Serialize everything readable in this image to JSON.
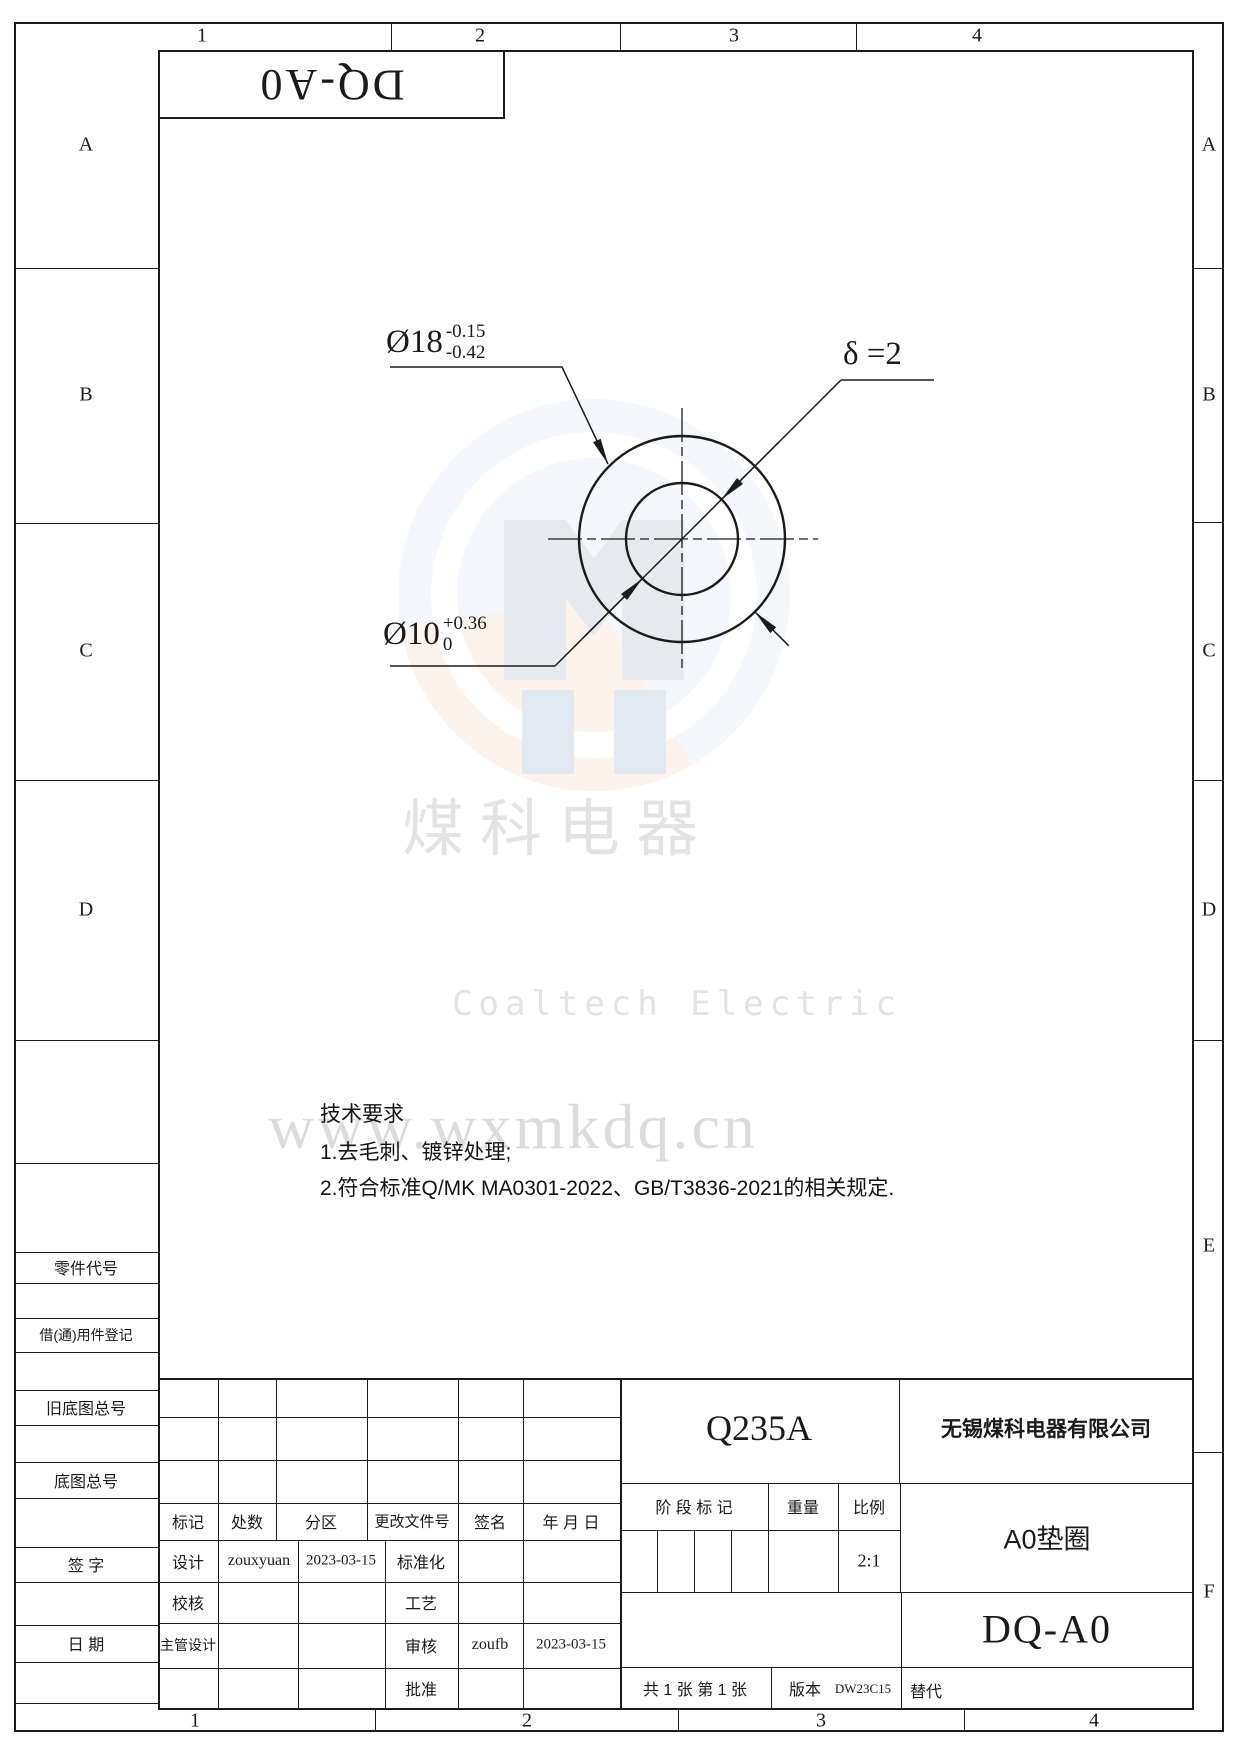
{
  "zones": {
    "top": [
      "1",
      "2",
      "3",
      "4"
    ],
    "bottom": [
      "1",
      "2",
      "3",
      "4"
    ],
    "left": [
      "A",
      "B",
      "C",
      "D"
    ],
    "right": [
      "A",
      "B",
      "C",
      "D",
      "E",
      "F"
    ]
  },
  "margin_labels": {
    "part_code": "零件代号",
    "borrow": "借(通)用件登记",
    "old_master": "旧底图总号",
    "master": "底图总号",
    "sign": "签 字",
    "date": "日 期"
  },
  "stamp": {
    "text": "DQ-A0"
  },
  "drawing": {
    "outer_dia": {
      "base": "Ø18",
      "upper": "-0.15",
      "lower": "-0.42"
    },
    "inner_dia": {
      "base": "Ø10",
      "upper": "+0.36",
      "lower": "0"
    },
    "thickness": "δ =2"
  },
  "watermark": {
    "cn": "煤科电器",
    "en": "Coaltech Electric",
    "url": "www.wxmkdq.cn"
  },
  "tech": {
    "title": "技术要求",
    "line1": "1.去毛刺、镀锌处理;",
    "line2": "2.符合标准Q/MK MA0301-2022、GB/T3836-2021的相关规定."
  },
  "tb": {
    "material": "Q235A",
    "company": "无锡煤科电器有限公司",
    "h": {
      "mark": "标记",
      "count": "处数",
      "zone": "分区",
      "doc": "更改文件号",
      "sig": "签名",
      "date": "年 月 日"
    },
    "design": "设计",
    "design_name": "zouxyuan",
    "design_date": "2023-03-15",
    "std": "标准化",
    "check": "校核",
    "process": "工艺",
    "chief": "主管设计",
    "audit": "审核",
    "audit_name": "zoufb",
    "audit_date": "2023-03-15",
    "approve": "批准",
    "stage": "阶 段 标 记",
    "weight": "重量",
    "scale": "比例",
    "scale_v": "2:1",
    "part_name": "A0垫圈",
    "part_no": "DQ-A0",
    "sheets": "共 1 张  第 1 张",
    "ver": "版本",
    "ver_v": "DW23C15",
    "replace": "替代"
  }
}
